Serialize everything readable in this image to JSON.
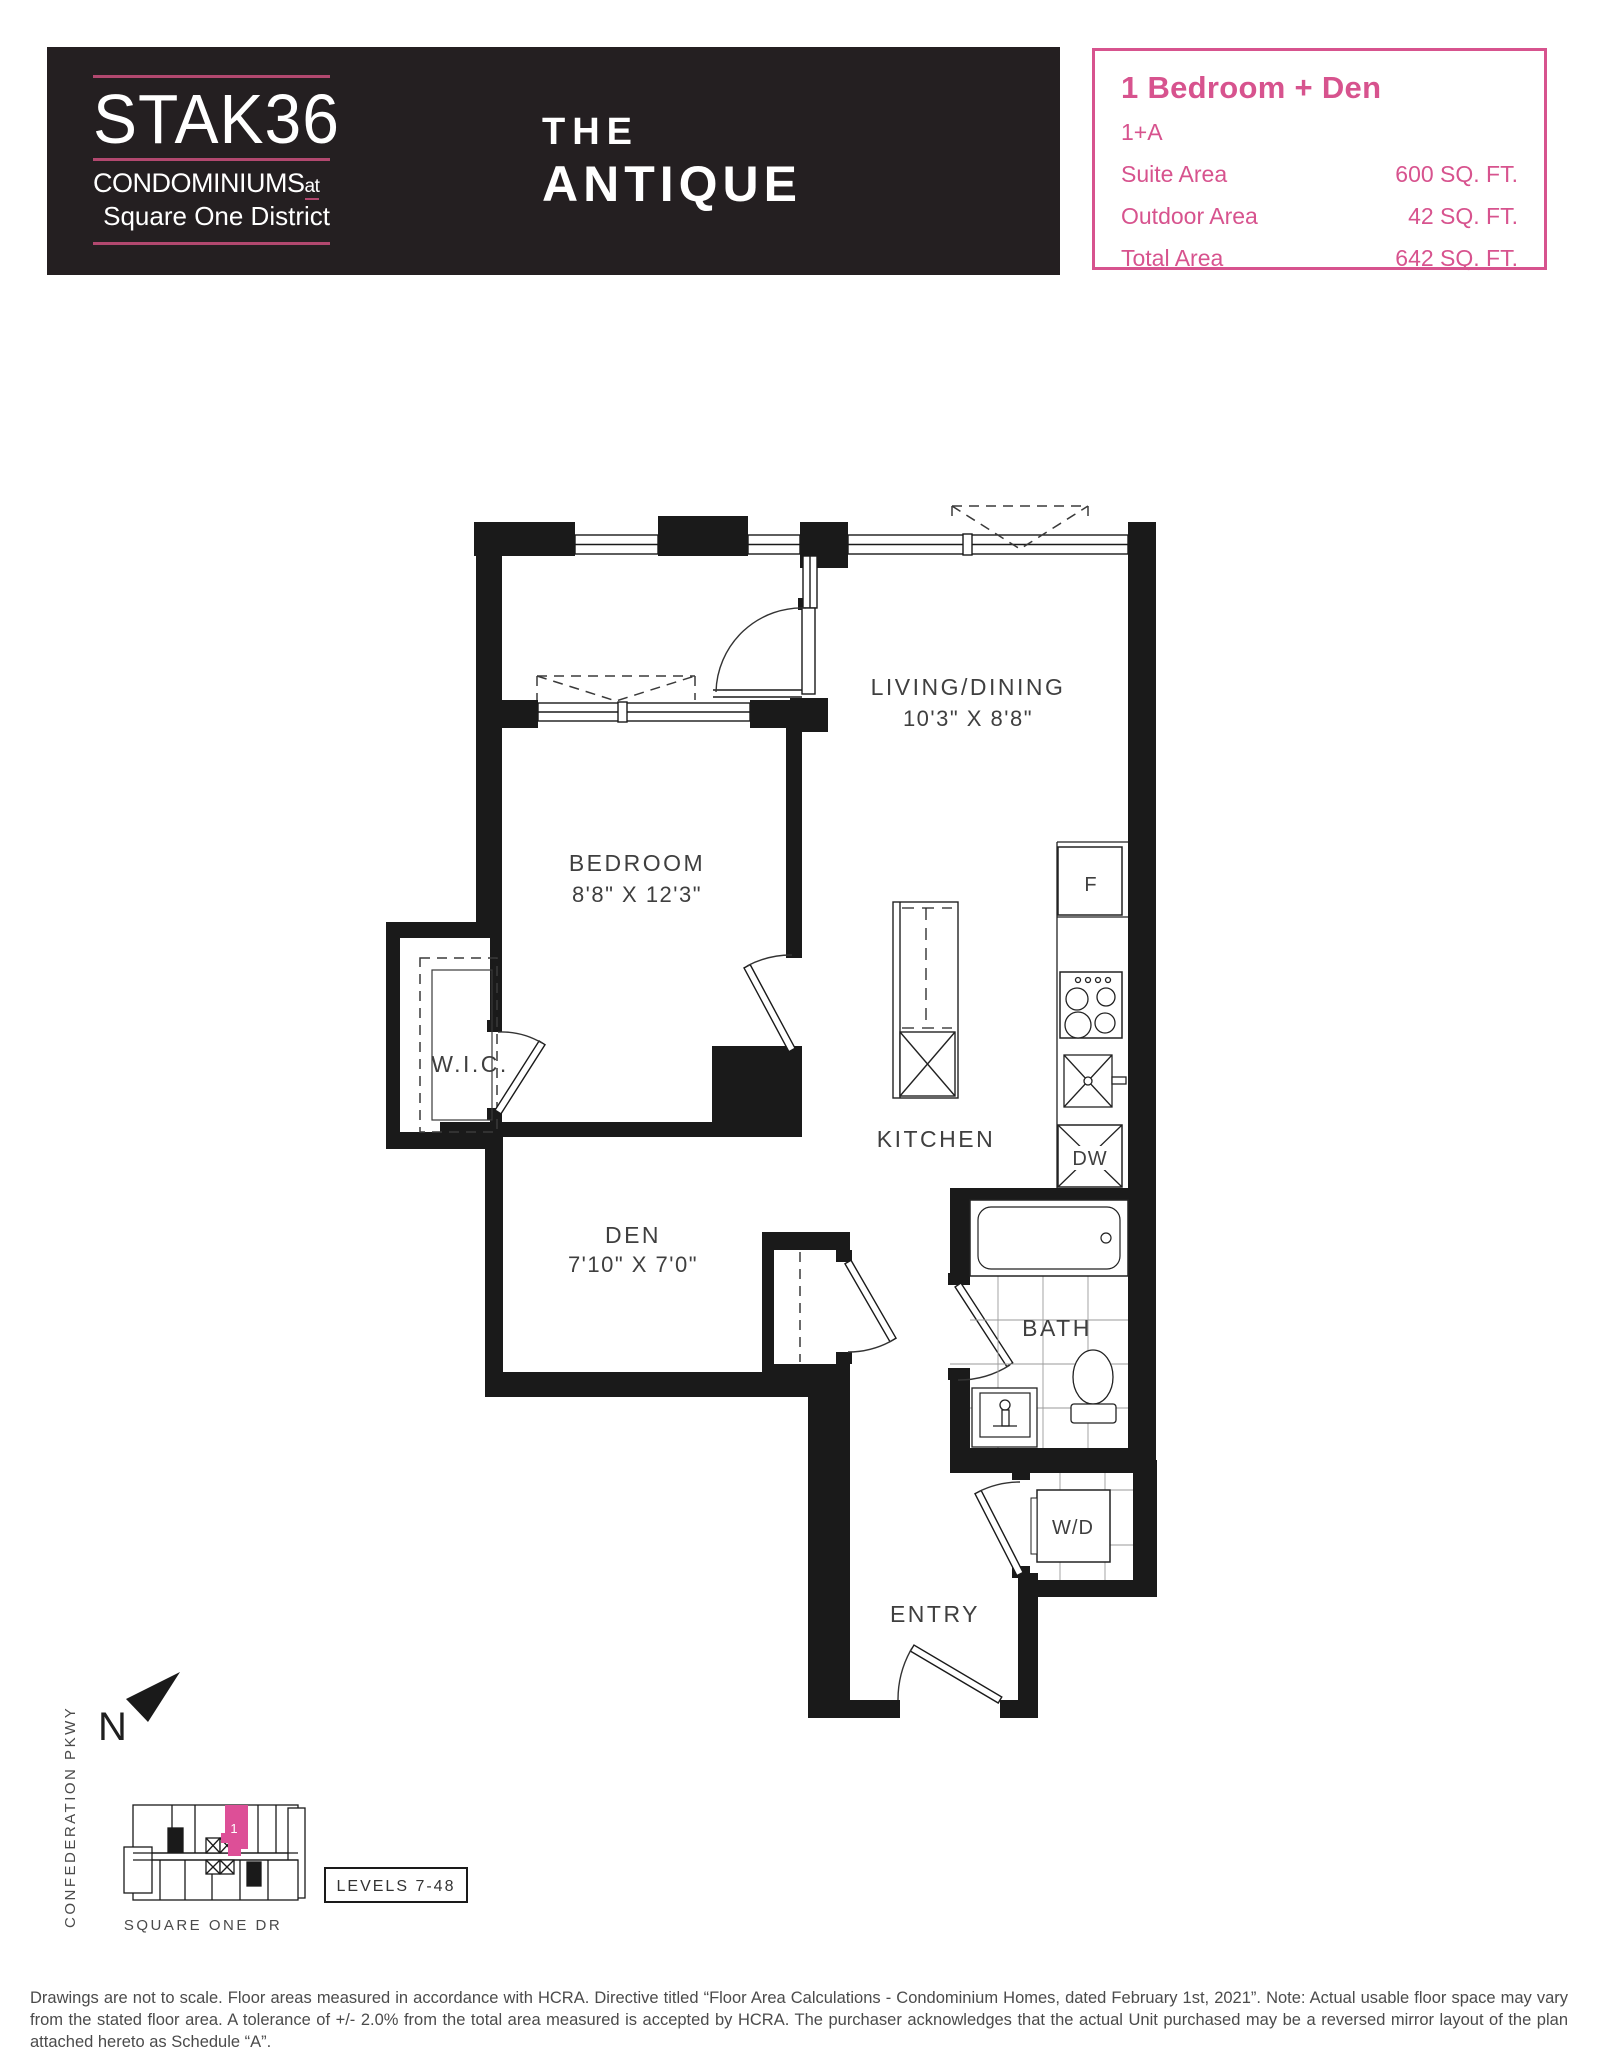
{
  "brand": {
    "name": "STAK36",
    "tagline_main": "CONDOMINIUMS",
    "tagline_at": "at",
    "tagline_sub": "Square One District",
    "accent_color": "#b2486f",
    "box_color": "#241f21"
  },
  "plan_title": {
    "line1": "THE",
    "line2": "ANTIQUE"
  },
  "info_box": {
    "accent_color": "#d7538e",
    "heading": "1 Bedroom + Den",
    "code": "1+A",
    "areas": [
      {
        "label": "Suite Area",
        "value": "600 SQ. FT."
      },
      {
        "label": "Outdoor Area",
        "value": "42 SQ. FT."
      },
      {
        "label": "Total Area",
        "value": "642 SQ. FT."
      }
    ]
  },
  "floorplan": {
    "living": {
      "name": "LIVING/DINING",
      "dims": "10'3\" X 8'8\""
    },
    "bedroom": {
      "name": "BEDROOM",
      "dims": "8'8\" X 12'3\""
    },
    "wic": {
      "name": "W.I.C."
    },
    "den": {
      "name": "DEN",
      "dims": "7'10\" X 7'0\""
    },
    "kitchen": {
      "name": "KITCHEN"
    },
    "bath": {
      "name": "BATH"
    },
    "entry": {
      "name": "ENTRY"
    },
    "fridge": "F",
    "dishwasher": "DW",
    "washer_dryer": "W/D"
  },
  "key_plan": {
    "north_label": "N",
    "street_left": "CONFEDERATION PKWY",
    "street_bottom": "SQUARE ONE DR",
    "levels": "LEVELS 7-48",
    "unit_number": "1",
    "unit_color": "#dd4f97"
  },
  "disclaimer": "Drawings are not to scale. Floor areas measured in accordance with HCRA. Directive titled “Floor Area Calculations - Condominium Homes, dated February 1st, 2021”. Note: Actual usable floor space may vary from the stated floor area. A tolerance of +/- 2.0% from the total area measured is accepted by HCRA. The purchaser acknowledges that the actual Unit purchased may be a reversed mirror layout of the plan attached hereto as Schedule “A”."
}
